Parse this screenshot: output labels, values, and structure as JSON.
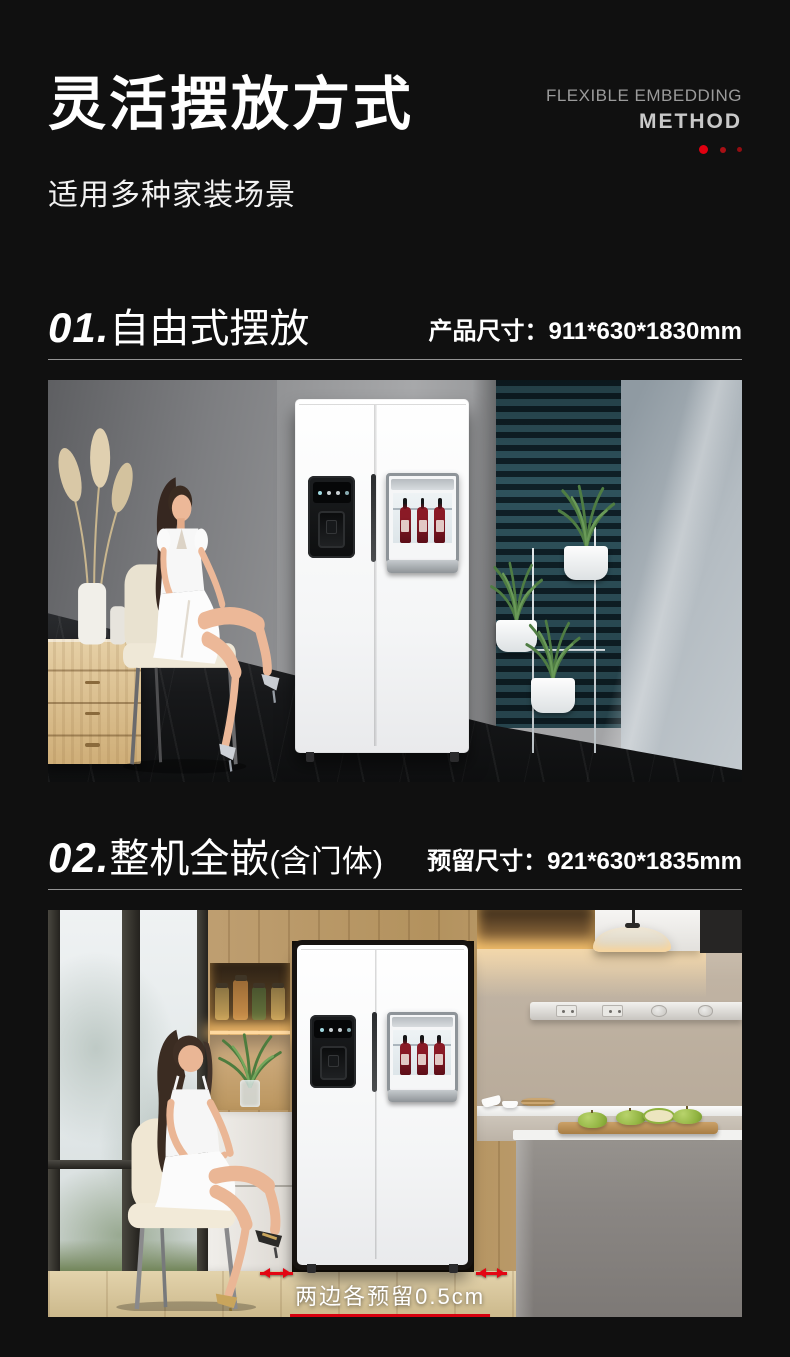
{
  "page": {
    "background": "#101010",
    "accent_red": "#e30613"
  },
  "header": {
    "title": "灵活摆放方式",
    "subtitle": "适用多种家装场景",
    "tagline_line1": "FLEXIBLE EMBEDDING",
    "tagline_line2": "METHOD",
    "accent_dots": [
      "#e10010",
      "#a81015",
      "#930d11"
    ]
  },
  "sections": [
    {
      "index": "01.",
      "title": "自由式摆放",
      "title_note": "",
      "spec_label": "产品尺寸：",
      "spec_value": "911*630*1830mm"
    },
    {
      "index": "02.",
      "title": "整机全嵌",
      "title_note": "(含门体)",
      "spec_label": "预留尺寸：",
      "spec_value": "921*630*1835mm",
      "photo_caption": "两边各预留0.5cm"
    }
  ]
}
